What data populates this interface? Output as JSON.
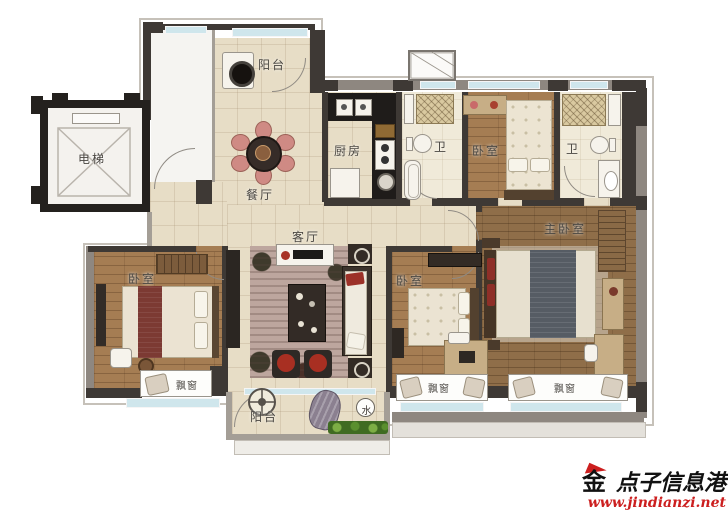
{
  "plan": {
    "rooms": {
      "elevator": {
        "label": "电梯"
      },
      "balcony_top": {
        "label": "阳台"
      },
      "dining": {
        "label": "餐厅"
      },
      "kitchen": {
        "label": "厨房"
      },
      "bath_a": {
        "label": "卫"
      },
      "bedroom_top": {
        "label": "卧室"
      },
      "bath_b": {
        "label": "卫"
      },
      "master_bedroom": {
        "label": "主卧室"
      },
      "living": {
        "label": "客厅"
      },
      "bedroom_left": {
        "label": "卧室"
      },
      "bedroom_mid": {
        "label": "卧室"
      },
      "balcony_bottom": {
        "label": "阳台"
      }
    },
    "features": {
      "bay_window_left": {
        "label": "飘窗"
      },
      "bay_window_mid": {
        "label": "飘窗"
      },
      "bay_window_right": {
        "label": "飘窗"
      },
      "water_meter": {
        "label": "水"
      }
    }
  },
  "watermark": {
    "logo_char": "金",
    "site_name": "点子信息港",
    "url": "www.jindianzi.net"
  },
  "colors": {
    "wall_dark": "#3e3935",
    "wall_gray": "#8e8780",
    "floor_tile": "#e7ddc6",
    "floor_wood": "#a57d53",
    "window_glass": "#cfe6ec",
    "accent_red": "#b03226",
    "watermark_red": "#cc1f1f"
  }
}
